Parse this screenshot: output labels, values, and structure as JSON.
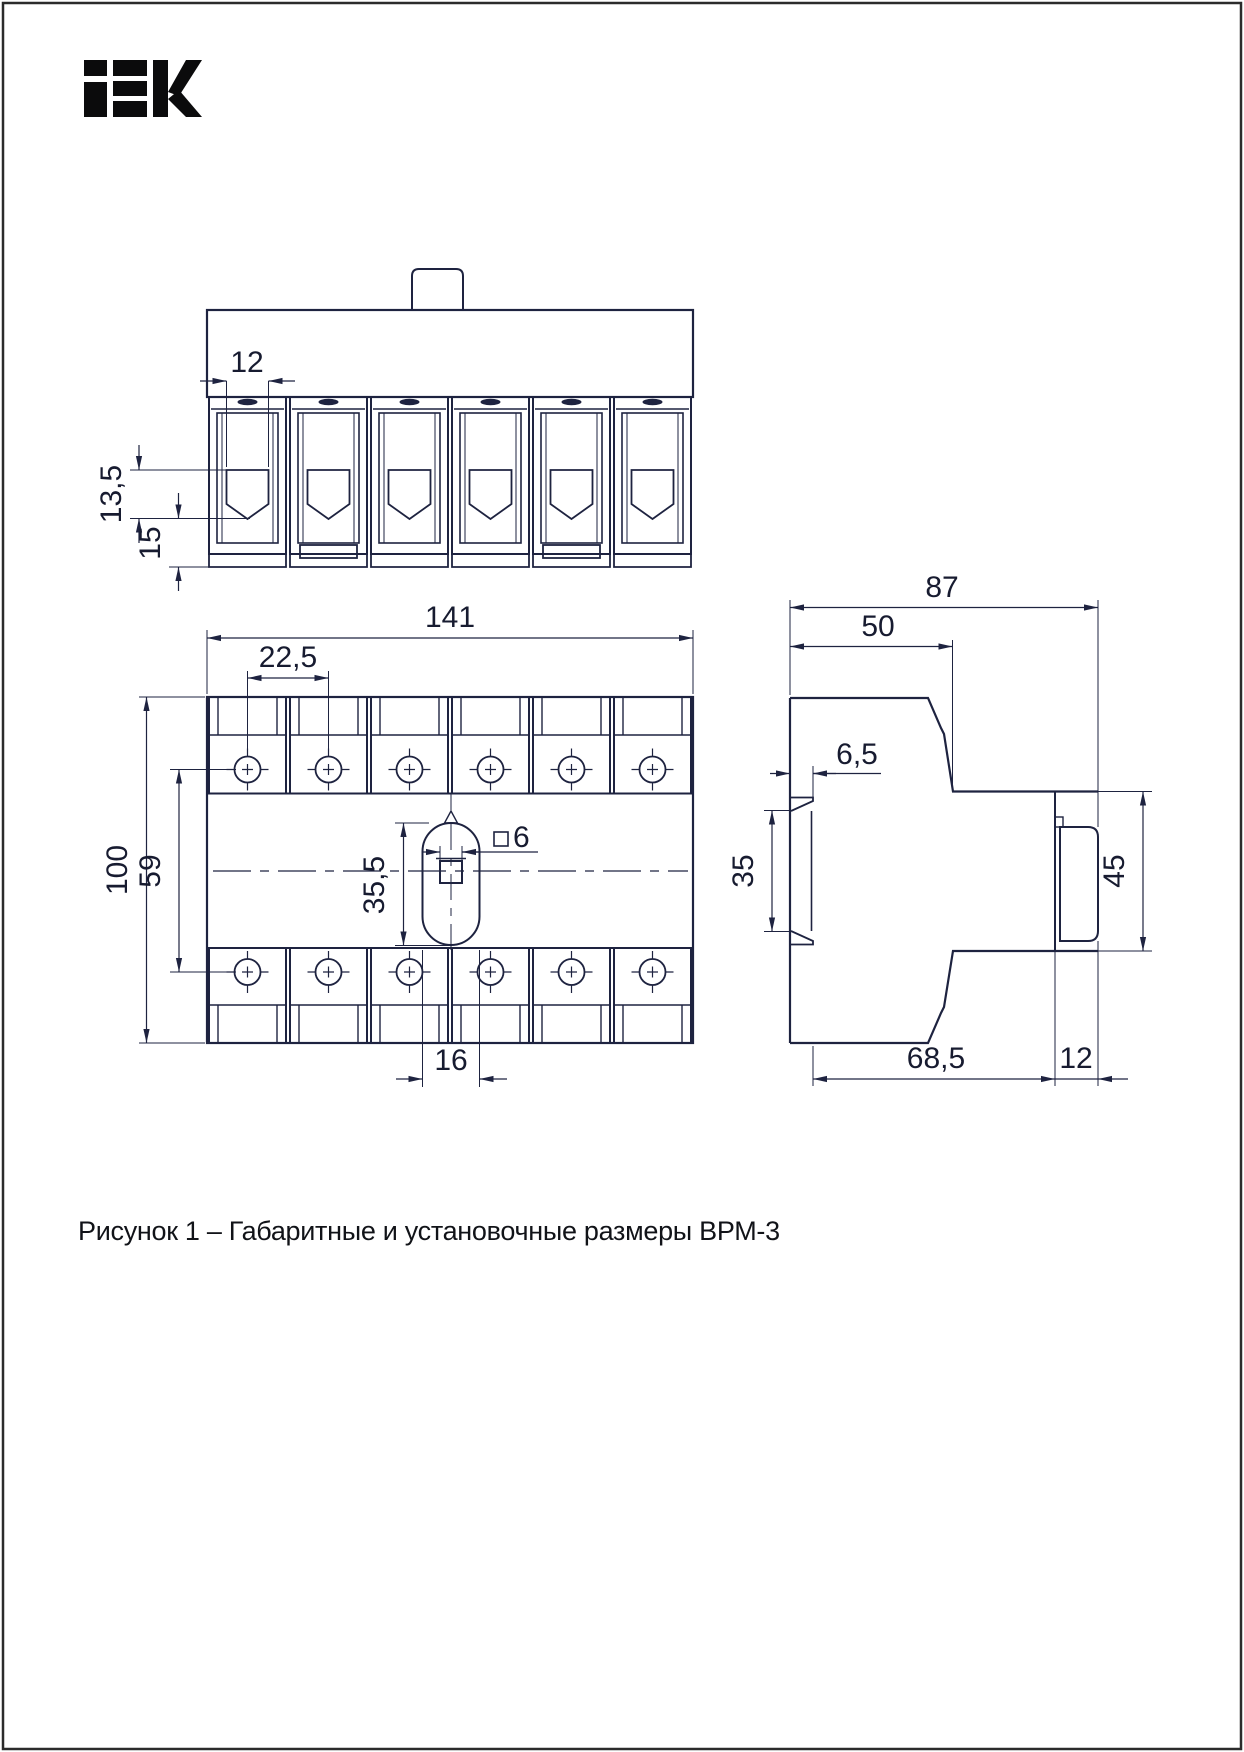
{
  "brand": "IEK",
  "caption": "Рисунок 1 – Габаритные и установочные размеры ВРМ-3",
  "dims": {
    "top": {
      "opening_width": "12",
      "jaw_depth": "13,5",
      "terminal_height": "15"
    },
    "front": {
      "overall_width": "141",
      "pole_pitch": "22,5",
      "overall_height": "100",
      "screw_row_spacing": "59",
      "aperture_height": "35,5",
      "shaft_square": "6",
      "aperture_width": "16"
    },
    "side": {
      "overall_depth": "87",
      "upper_depth": "50",
      "rail_offset": "6,5",
      "rail_height": "35",
      "block_height": "45",
      "lower_depth": "68,5",
      "block_depth": "12"
    }
  }
}
